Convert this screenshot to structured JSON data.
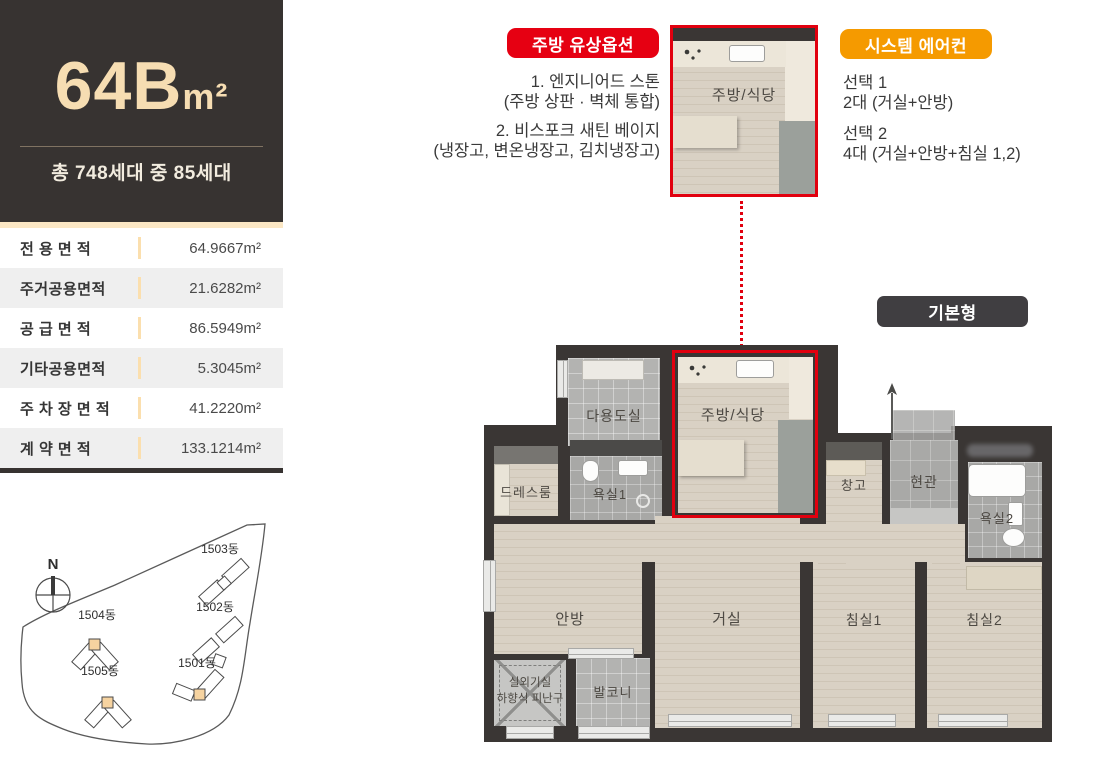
{
  "header": {
    "title_main": "64B",
    "title_unit": "m²",
    "subtitle": "총 748세대 중 85세대"
  },
  "area_table": {
    "rows": [
      {
        "label": "전 용 면 적",
        "value": "64.9667m²"
      },
      {
        "label": "주거공용면적",
        "value": "21.6282m²"
      },
      {
        "label": "공 급 면 적",
        "value": "86.5949m²"
      },
      {
        "label": "기타공용면적",
        "value": "5.3045m²"
      },
      {
        "label": "주 차 장 면 적",
        "value": "41.2220m²"
      },
      {
        "label": "계 약 면 적",
        "value": "133.1214m²"
      }
    ]
  },
  "kitchen_option": {
    "badge": "주방 유상옵션",
    "lines": [
      "1. 엔지니어드 스톤",
      "(주방 상판 · 벽체 통합)",
      "2. 비스포크 새틴 베이지",
      "(냉장고, 변온냉장고, 김치냉장고)"
    ]
  },
  "aircon_option": {
    "badge": "시스템 에어컨",
    "lines": [
      "선택 1",
      "2대 (거실+안방)",
      "선택 2",
      "4대 (거실+안방+침실 1,2)"
    ]
  },
  "plan": {
    "type_badge": "기본형",
    "detail_label": "주방/식당",
    "rooms": {
      "utility": "다용도실",
      "kitchen": "주방/식당",
      "dress": "드레스룸",
      "bath1": "욕실1",
      "storage": "창고",
      "entrance": "현관",
      "bath2": "욕실2",
      "master": "안방",
      "living": "거실",
      "bed1": "침실1",
      "bed2": "침실2",
      "outdoor_line1": "실외기실",
      "outdoor_line2": "하향식 피난구",
      "balcony": "발코니"
    }
  },
  "site_map": {
    "compass": "N",
    "buildings": [
      "1503동",
      "1502동",
      "1504동",
      "1505동",
      "1501동"
    ]
  },
  "colors": {
    "accent_red": "#e60012",
    "accent_orange": "#f59a00",
    "header_dark": "#373331",
    "title_cream": "#f6ddb2",
    "peach": "#fbe7c4",
    "wall": "#3a3634",
    "highlight_unit": "#f6d3a0"
  }
}
